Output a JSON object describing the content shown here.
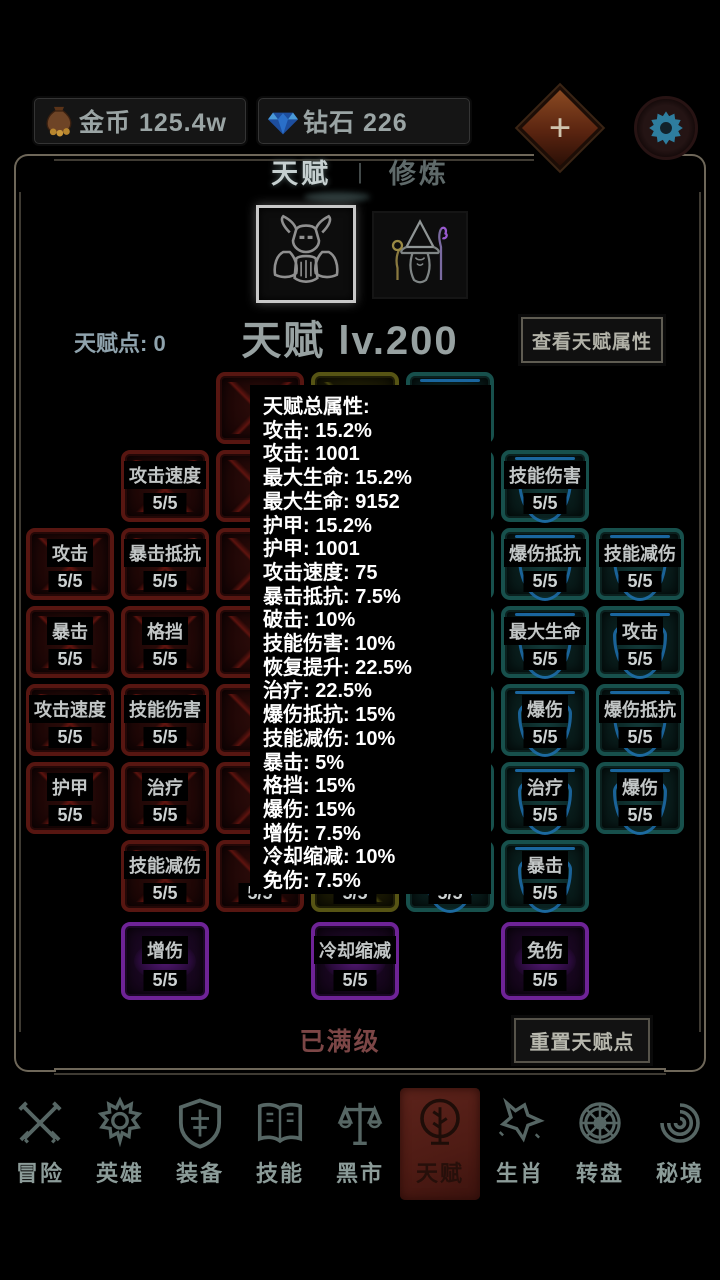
{
  "top_bar": {
    "gold": {
      "icon": "money-bag-icon",
      "label": "金币",
      "value": "125.4w"
    },
    "diamond": {
      "icon": "diamond-icon",
      "label": "钻石",
      "value": "226"
    },
    "plus_label": "+"
  },
  "tabs": {
    "talent": "天赋",
    "divider": "|",
    "cultivate": "修炼"
  },
  "characters": [
    {
      "name": "warrior",
      "selected": true
    },
    {
      "name": "mage",
      "selected": false
    }
  ],
  "talent_header": {
    "points_label": "天赋点:",
    "points_value": "0",
    "points_text": "天赋点: 0",
    "level_text": "天赋 lv.200",
    "view_button": "查看天赋属性"
  },
  "stats_popup": {
    "lines": [
      "天赋总属性:",
      "攻击: 15.2%",
      "攻击: 1001",
      "最大生命: 15.2%",
      "最大生命: 9152",
      "护甲: 15.2%",
      "护甲: 1001",
      "攻击速度: 75",
      "暴击抵抗: 7.5%",
      "破击: 10%",
      "技能伤害: 10%",
      "恢复提升: 22.5%",
      "治疗: 22.5%",
      "爆伤抵抗: 15%",
      "技能减伤: 10%",
      "暴击: 5%",
      "格挡: 15%",
      "爆伤: 15%",
      "增伤: 7.5%",
      "冷却缩减: 10%",
      "免伤: 7.5%"
    ]
  },
  "talent_grid": {
    "nodes": [
      {
        "col": 1,
        "row": 2,
        "color": "red",
        "label": "攻击",
        "level": "5/5"
      },
      {
        "col": 1,
        "row": 3,
        "color": "red",
        "label": "暴击",
        "level": "5/5"
      },
      {
        "col": 1,
        "row": 4,
        "color": "red",
        "label": "攻击速度",
        "level": "5/5"
      },
      {
        "col": 1,
        "row": 5,
        "color": "red",
        "label": "护甲",
        "level": "5/5"
      },
      {
        "col": 2,
        "row": 1,
        "color": "red",
        "label": "攻击速度",
        "level": "5/5"
      },
      {
        "col": 2,
        "row": 2,
        "color": "red",
        "label": "暴击抵抗",
        "level": "5/5"
      },
      {
        "col": 2,
        "row": 3,
        "color": "red",
        "label": "格挡",
        "level": "5/5"
      },
      {
        "col": 2,
        "row": 4,
        "color": "red",
        "label": "技能伤害",
        "level": "5/5"
      },
      {
        "col": 2,
        "row": 5,
        "color": "red",
        "label": "治疗",
        "level": "5/5"
      },
      {
        "col": 2,
        "row": 6,
        "color": "red",
        "label": "技能减伤",
        "level": "5/5"
      },
      {
        "col": 3,
        "row": 0,
        "color": "red",
        "label": "",
        "level": ""
      },
      {
        "col": 3,
        "row": 1,
        "color": "red",
        "label": "",
        "level": ""
      },
      {
        "col": 3,
        "row": 2,
        "color": "red",
        "label": "",
        "level": ""
      },
      {
        "col": 3,
        "row": 3,
        "color": "red",
        "label": "",
        "level": ""
      },
      {
        "col": 3,
        "row": 4,
        "color": "red",
        "label": "",
        "level": ""
      },
      {
        "col": 3,
        "row": 5,
        "color": "red",
        "label": "",
        "level": ""
      },
      {
        "col": 3,
        "row": 6,
        "color": "red",
        "label": "",
        "level": "5/5"
      },
      {
        "col": 4,
        "row": 0,
        "color": "yellow",
        "label": "",
        "level": ""
      },
      {
        "col": 4,
        "row": 1,
        "color": "yellow",
        "label": "",
        "level": ""
      },
      {
        "col": 4,
        "row": 2,
        "color": "yellow",
        "label": "",
        "level": ""
      },
      {
        "col": 4,
        "row": 3,
        "color": "yellow",
        "label": "",
        "level": ""
      },
      {
        "col": 4,
        "row": 4,
        "color": "yellow",
        "label": "",
        "level": ""
      },
      {
        "col": 4,
        "row": 5,
        "color": "yellow",
        "label": "",
        "level": ""
      },
      {
        "col": 4,
        "row": 6,
        "color": "yellow",
        "label": "",
        "level": "5/5"
      },
      {
        "col": 5,
        "row": 0,
        "color": "teal",
        "label": "",
        "level": ""
      },
      {
        "col": 5,
        "row": 1,
        "color": "teal",
        "label": "",
        "level": ""
      },
      {
        "col": 5,
        "row": 2,
        "color": "teal",
        "label": "",
        "level": ""
      },
      {
        "col": 5,
        "row": 3,
        "color": "teal",
        "label": "",
        "level": ""
      },
      {
        "col": 5,
        "row": 4,
        "color": "teal",
        "label": "",
        "level": ""
      },
      {
        "col": 5,
        "row": 5,
        "color": "teal",
        "label": "",
        "level": ""
      },
      {
        "col": 5,
        "row": 6,
        "color": "teal",
        "label": "",
        "level": "5/5"
      },
      {
        "col": 6,
        "row": 1,
        "color": "teal",
        "label": "技能伤害",
        "level": "5/5"
      },
      {
        "col": 6,
        "row": 2,
        "color": "teal",
        "label": "爆伤抵抗",
        "level": "5/5"
      },
      {
        "col": 6,
        "row": 3,
        "color": "teal",
        "label": "最大生命",
        "level": "5/5"
      },
      {
        "col": 6,
        "row": 4,
        "color": "teal",
        "label": "爆伤",
        "level": "5/5"
      },
      {
        "col": 6,
        "row": 5,
        "color": "teal",
        "label": "治疗",
        "level": "5/5"
      },
      {
        "col": 6,
        "row": 6,
        "color": "teal",
        "label": "暴击",
        "level": "5/5"
      },
      {
        "col": 7,
        "row": 2,
        "color": "teal",
        "label": "技能减伤",
        "level": "5/5"
      },
      {
        "col": 7,
        "row": 3,
        "color": "teal",
        "label": "攻击",
        "level": "5/5"
      },
      {
        "col": 7,
        "row": 4,
        "color": "teal",
        "label": "爆伤抵抗",
        "level": "5/5"
      },
      {
        "col": 7,
        "row": 5,
        "color": "teal",
        "label": "爆伤",
        "level": "5/5"
      },
      {
        "col": 2,
        "row": 7,
        "color": "purple",
        "label": "增伤",
        "level": "5/5"
      },
      {
        "col": 4,
        "row": 7,
        "color": "purple",
        "label": "冷却缩减",
        "level": "5/5"
      },
      {
        "col": 6,
        "row": 7,
        "color": "purple",
        "label": "免伤",
        "level": "5/5"
      }
    ]
  },
  "footer": {
    "max_level_text": "已满级",
    "reset_button": "重置天赋点"
  },
  "nav": {
    "items": [
      {
        "label": "冒险",
        "icon": "crossed-swords-icon",
        "active": false
      },
      {
        "label": "英雄",
        "icon": "hero-icon",
        "active": false
      },
      {
        "label": "装备",
        "icon": "shield-icon",
        "active": false
      },
      {
        "label": "技能",
        "icon": "book-icon",
        "active": false
      },
      {
        "label": "黑市",
        "icon": "scales-icon",
        "active": false
      },
      {
        "label": "天赋",
        "icon": "tree-icon",
        "active": true
      },
      {
        "label": "生肖",
        "icon": "wolf-icon",
        "active": false
      },
      {
        "label": "转盘",
        "icon": "wheel-icon",
        "active": false
      },
      {
        "label": "秘境",
        "icon": "vortex-icon",
        "active": false
      }
    ]
  },
  "colors": {
    "node_red": "#571611",
    "node_yellow": "#565414",
    "node_teal": "#17504c",
    "node_purple": "#6e2396",
    "nav_active_bg": "#5c231b",
    "gear_blue": "#2e7d9e",
    "plus_bg": "#7a3a1d",
    "max_level_text": "#7c4646"
  }
}
